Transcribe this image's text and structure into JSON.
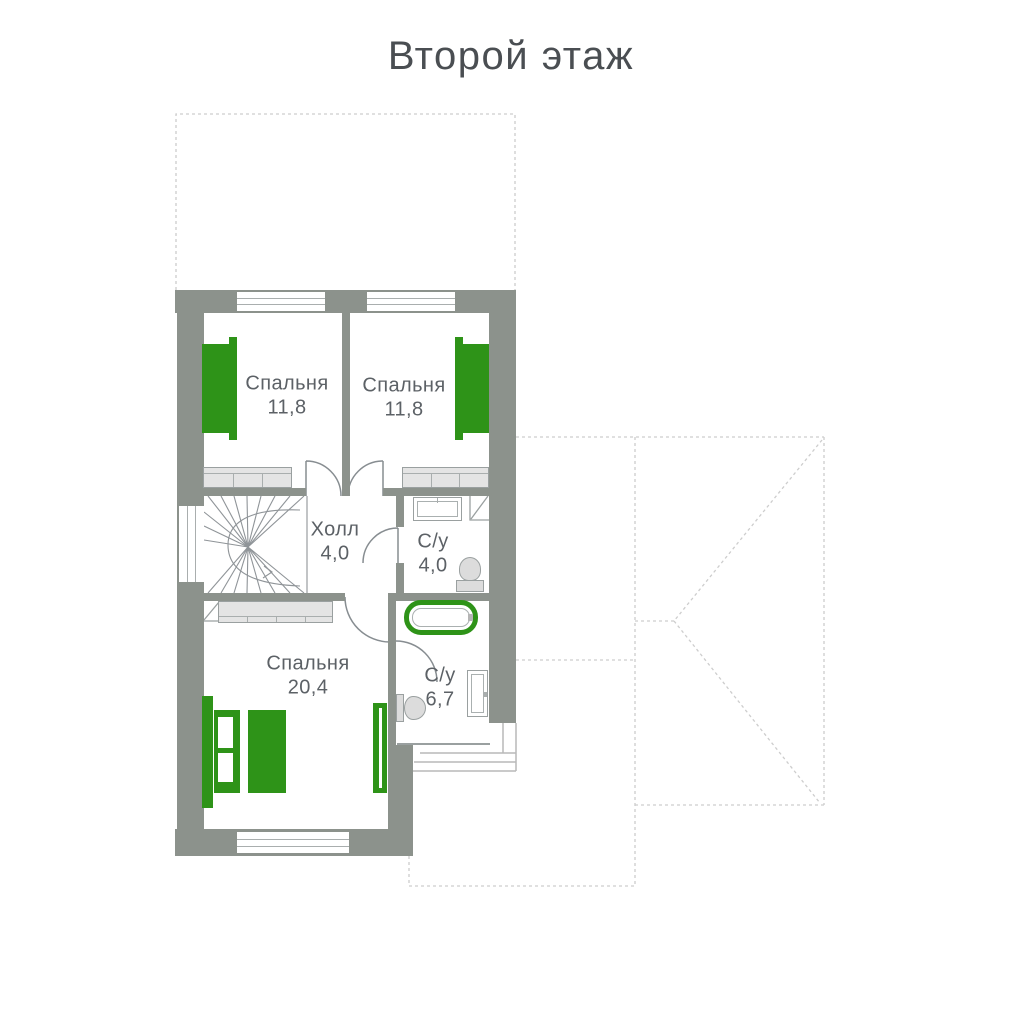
{
  "title": "Второй этаж",
  "colors": {
    "wall_gray": "#8c928c",
    "accent_green": "#2e9318",
    "furniture_fill": "#e4e4e4",
    "outline_gray": "#9aa0a0",
    "label_text": "#5c6166",
    "title_text": "#4a4e52",
    "roof_dash": "#cdcdcd"
  },
  "rooms": [
    {
      "id": "bedroom-1",
      "name": "Спальня",
      "area": "11,8"
    },
    {
      "id": "bedroom-2",
      "name": "Спальня",
      "area": "11,8"
    },
    {
      "id": "hall",
      "name": "Холл",
      "area": "4,0"
    },
    {
      "id": "bathroom-1",
      "name": "С/у",
      "area": "4,0"
    },
    {
      "id": "bedroom-3",
      "name": "Спальня",
      "area": "20,4"
    },
    {
      "id": "bathroom-2",
      "name": "С/у",
      "area": "6,7"
    }
  ]
}
